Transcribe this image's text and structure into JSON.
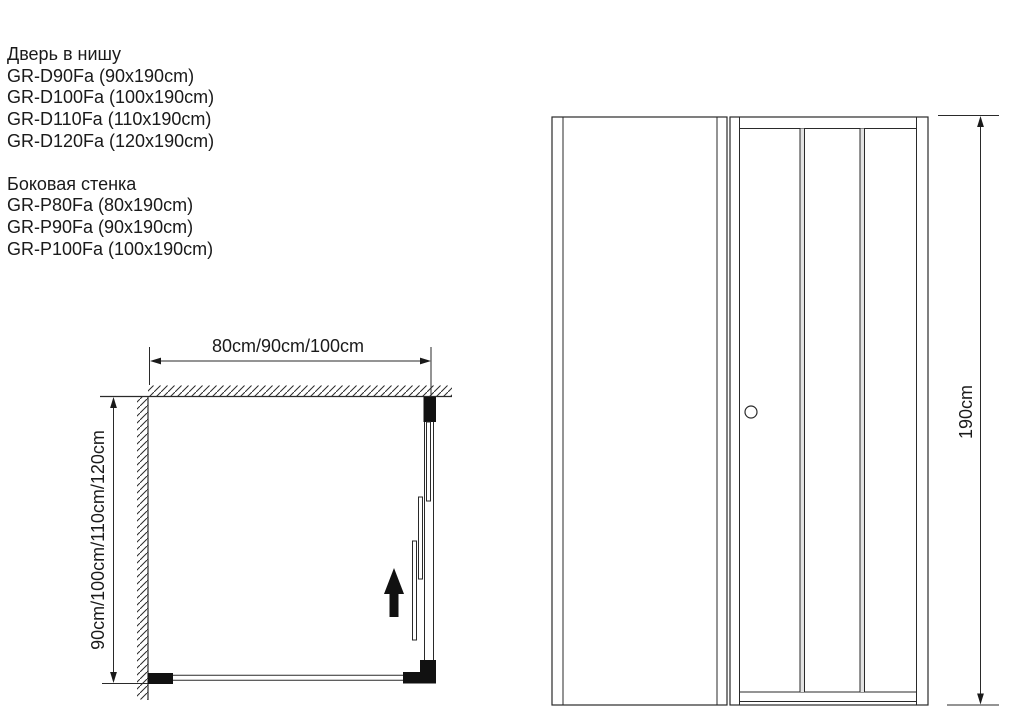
{
  "products": {
    "doors": {
      "title": "Дверь в нишу",
      "items": [
        "GR-D90Fa (90x190cm)",
        "GR-D100Fa (100x190cm)",
        "GR-D110Fa (110x190cm)",
        "GR-D120Fa (120x190cm)"
      ]
    },
    "side_walls": {
      "title": "Боковая стенка",
      "items": [
        "GR-P80Fa (80x190cm)",
        "GR-P90Fa (90x190cm)",
        "GR-P100Fa (100x190cm)"
      ]
    }
  },
  "plan_view": {
    "width_dimension": "80cm/90cm/100cm",
    "depth_dimension": "90cm/100cm/110cm/120cm"
  },
  "front_view": {
    "height_dimension": "190cm"
  },
  "colors": {
    "line": "#2a2a2a",
    "profile_fill": "#111111",
    "background": "#ffffff"
  }
}
